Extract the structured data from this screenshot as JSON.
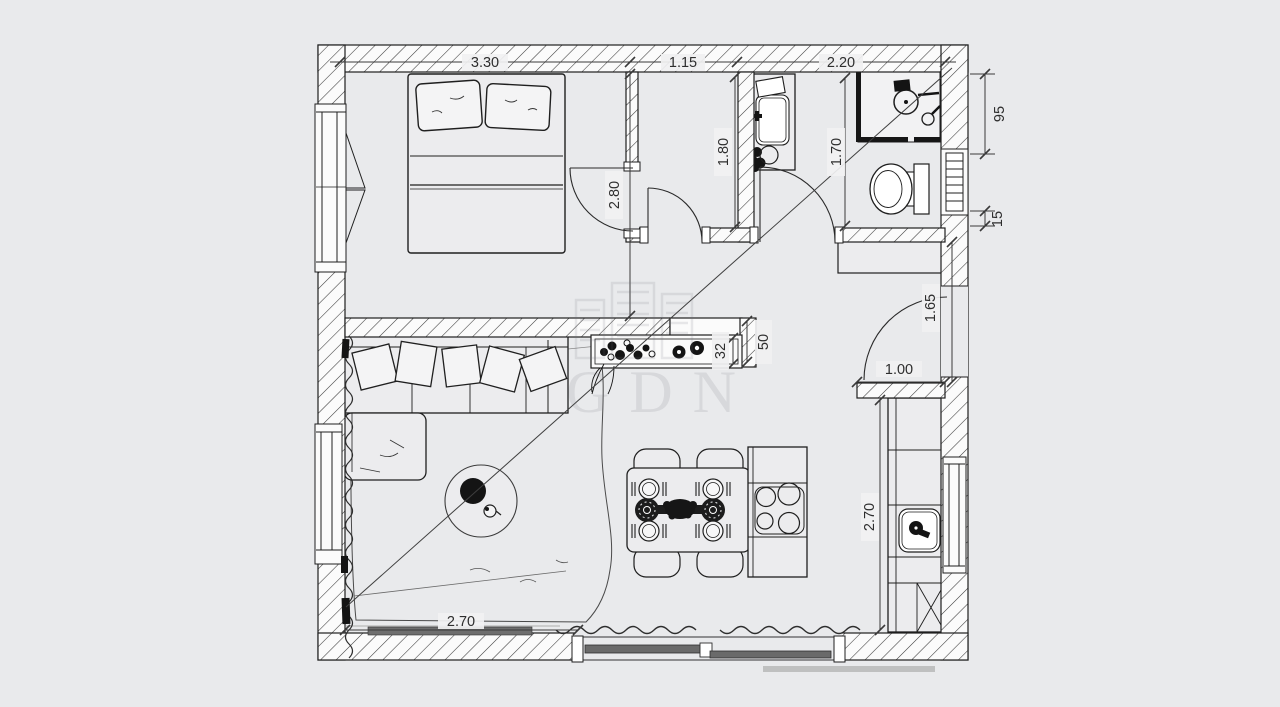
{
  "plan": {
    "type": "apartment-floor-plan",
    "colors": {
      "background": "#e9eaec",
      "line": "#222222",
      "wall_fill": "#fbfbfb",
      "glazing": "#6a6a6a"
    },
    "watermark": {
      "letters": "GDN"
    },
    "dims": {
      "bedroom_width": "3.30",
      "closet_width": "1.15",
      "bath_width": "2.20",
      "bedroom_depth": "2.80",
      "closet_depth": "1.80",
      "bath_depth": "1.70",
      "shower_width_cm": "95",
      "niche_cm": "15",
      "hall_depth": "1.65",
      "entry_door_width": "1.00",
      "counter_depth_cm": "32",
      "counter_clear_cm": "50",
      "kitchen_run_m": "2.70",
      "terrace_window_m": "2.70"
    }
  }
}
